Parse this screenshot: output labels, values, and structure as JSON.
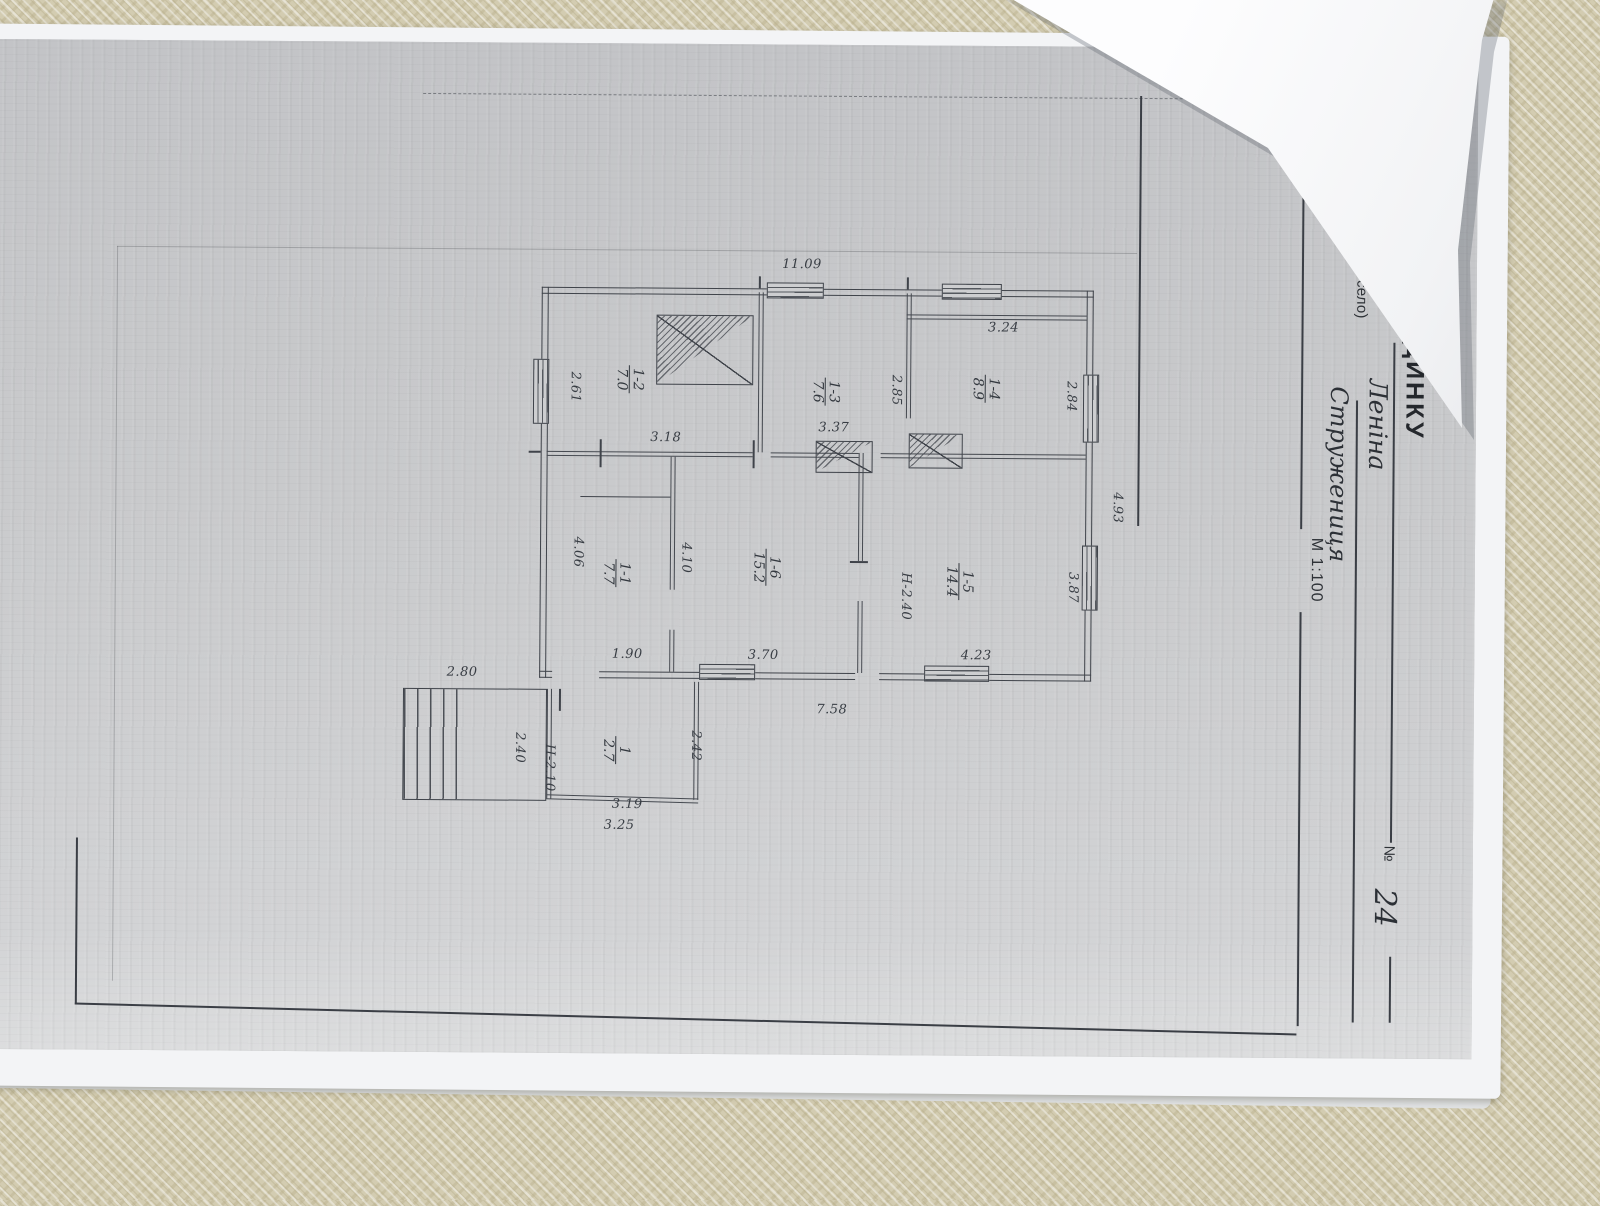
{
  "colors": {
    "table_beige": "#d3ccb1",
    "paper_gray": "#c8c9cb",
    "ink": "#3f434a"
  },
  "form": {
    "title": "ПЛАН БУДИНКУ",
    "street_label": "вулиця (провулок, площа)",
    "street_value": "Леніна",
    "number_label": "№",
    "number_value": "24",
    "city_label": "місто (селище, село)",
    "city_value": "Стружениця",
    "scale": "М 1:100"
  },
  "plan": {
    "rooms": [
      {
        "num": "1-2",
        "area": "7.0"
      },
      {
        "num": "1-3",
        "area": "7.6"
      },
      {
        "num": "1-4",
        "area": "8.9"
      },
      {
        "num": "1-1",
        "area": "7.7"
      },
      {
        "num": "1-6",
        "area": "15.2"
      },
      {
        "num": "1-5",
        "area": "14.4"
      },
      {
        "num": "1",
        "area": "2.7"
      }
    ],
    "dims": {
      "top": "11.09",
      "bottom": "7.58",
      "right": "4.93",
      "r12_w": "3.18",
      "r12_h": "2.61",
      "r13_w": "3.37",
      "r13_h": "2.85",
      "r14_w": "3.24",
      "r14_h": "2.84",
      "r11_w": "1.90",
      "r11_h": "4.06",
      "r16_w": "3.70",
      "r16_h": "4.10",
      "r15_w": "4.23",
      "r15_h": "3.87",
      "r15_note": "Н-2.40",
      "porch_w": "2.80",
      "porch_h": "2.40",
      "annex_note": "Н-2.10",
      "annex_h": "2.42",
      "annex_w1": "3.19",
      "annex_w2": "3.25"
    }
  }
}
